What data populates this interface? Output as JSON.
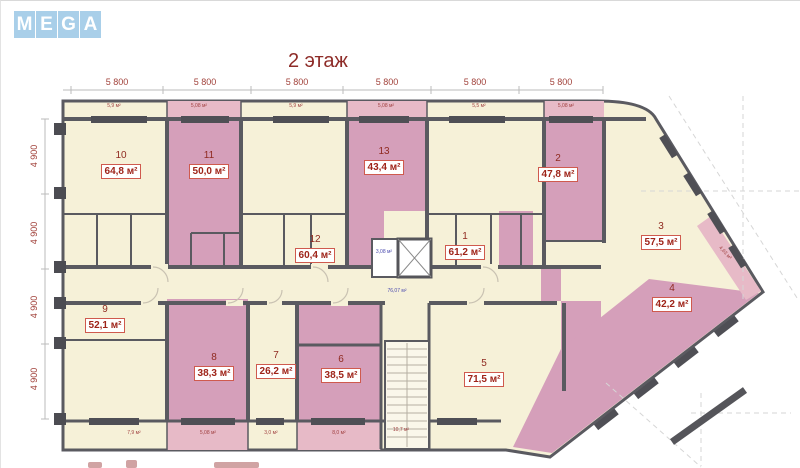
{
  "logo": {
    "letters": [
      "M",
      "E",
      "G",
      "A"
    ],
    "tile_color": "#a9cfe9"
  },
  "title": "2 этаж",
  "dims": {
    "top": [
      "5 800",
      "5 800",
      "5 800",
      "5 800",
      "5 800",
      "5 800"
    ],
    "left": [
      "4 900",
      "4 900",
      "4 900",
      "4 900"
    ]
  },
  "rooms": [
    {
      "number": "1",
      "area": "61,2 м²",
      "color": "cream"
    },
    {
      "number": "2",
      "area": "47,8 м²",
      "color": "pink"
    },
    {
      "number": "3",
      "area": "57,5 м²",
      "color": "cream"
    },
    {
      "number": "4",
      "area": "42,2 м²",
      "color": "pink"
    },
    {
      "number": "5",
      "area": "71,5 м²",
      "color": "cream"
    },
    {
      "number": "6",
      "area": "38,5 м²",
      "color": "pink"
    },
    {
      "number": "7",
      "area": "26,2 м²",
      "color": "cream"
    },
    {
      "number": "8",
      "area": "38,3 м²",
      "color": "pink"
    },
    {
      "number": "9",
      "area": "52,1 м²",
      "color": "cream"
    },
    {
      "number": "10",
      "area": "64,8 м²",
      "color": "cream"
    },
    {
      "number": "11",
      "area": "50,0 м²",
      "color": "pink"
    },
    {
      "number": "12",
      "area": "60,4 м²",
      "color": "cream"
    },
    {
      "number": "13",
      "area": "43,4 м²",
      "color": "pink"
    }
  ],
  "core": {
    "elevator_lobby_area": "3,08 м²",
    "corridor_area": "76,07 м²"
  },
  "balconies": {
    "top": [
      "5,9 м²",
      "5,08 м²",
      "5,9 м²",
      "5,08 м²",
      "5,5 м²",
      "5,08 м²"
    ],
    "bottom": [
      "7,9 м²",
      "5,08 м²",
      "3,0 м²",
      "8,0 м²",
      "10,7 м²"
    ],
    "right": "4,63 м²"
  },
  "colors": {
    "cream": "#f6f1d8",
    "pink": "#d59fba",
    "balcony_pink": "#e7bac7",
    "wall": "#5a5a60",
    "label_red": "#9e2318",
    "dim_red": "#a1413a",
    "blue_label": "#4a4aae",
    "logo_blue": "#a9cfe9"
  }
}
